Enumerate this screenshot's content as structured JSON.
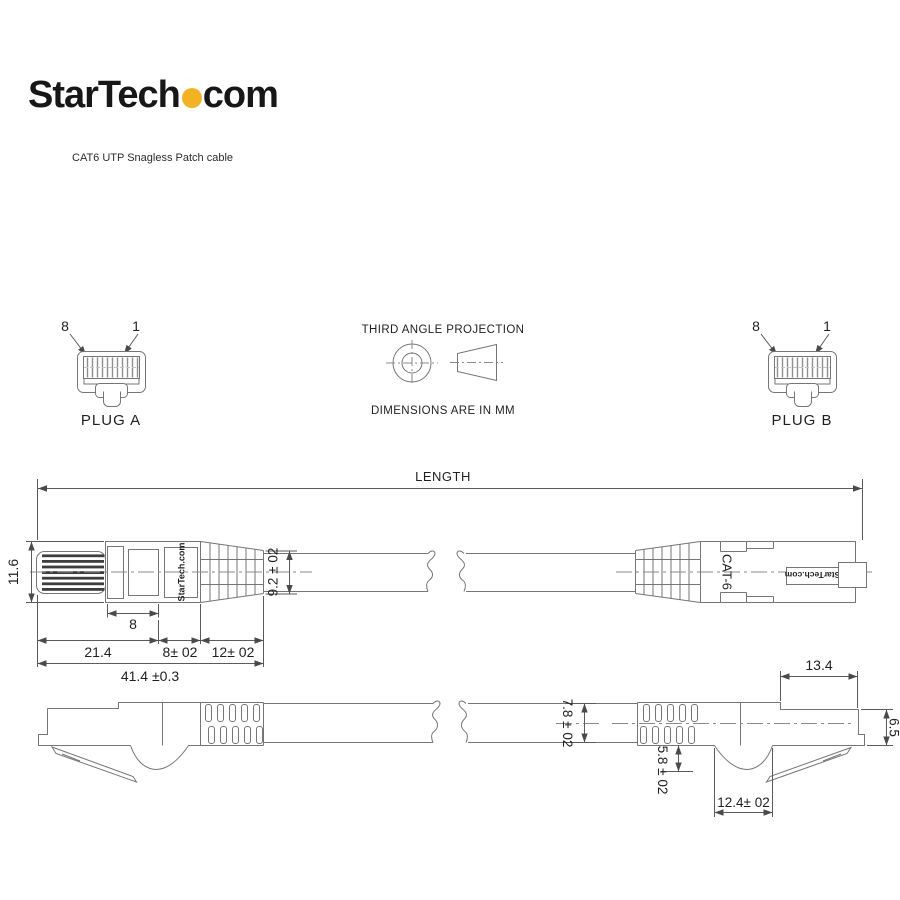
{
  "header": {
    "logo_part1": "StarTech",
    "logo_part2": "com",
    "subtitle": "CAT6 UTP Snagless Patch cable"
  },
  "projection": {
    "title": "THIRD ANGLE PROJECTION",
    "units_note": "DIMENSIONS ARE IN MM"
  },
  "plug_a": {
    "label": "PLUG A",
    "pin_first": "8",
    "pin_last": "1"
  },
  "plug_b": {
    "label": "PLUG B",
    "pin_first": "8",
    "pin_last": "1"
  },
  "top_view": {
    "length_label": "LENGTH",
    "left_brand": "StarTech.com",
    "cable_marking": "CAT-6",
    "right_brand": "StarTech.com",
    "dims": {
      "connector_height": "11.6",
      "pin_zone": "8",
      "body_length": "21.4",
      "label_zone": "8± 02",
      "boot_zone": "12± 02",
      "total_length": "41.4 ±0.3",
      "boot_height": "9.2 ± 02"
    }
  },
  "side_view": {
    "dims": {
      "plug_front_length": "13.4",
      "plug_front_height": "6.5",
      "boot_height": "7.8 ± 02",
      "latch_depth": "5.8 ± 02",
      "hump_width": "12.4± 02"
    }
  },
  "colors": {
    "logo_dot": "#F2B225",
    "line": "#757575",
    "text": "#1f1f1f"
  }
}
